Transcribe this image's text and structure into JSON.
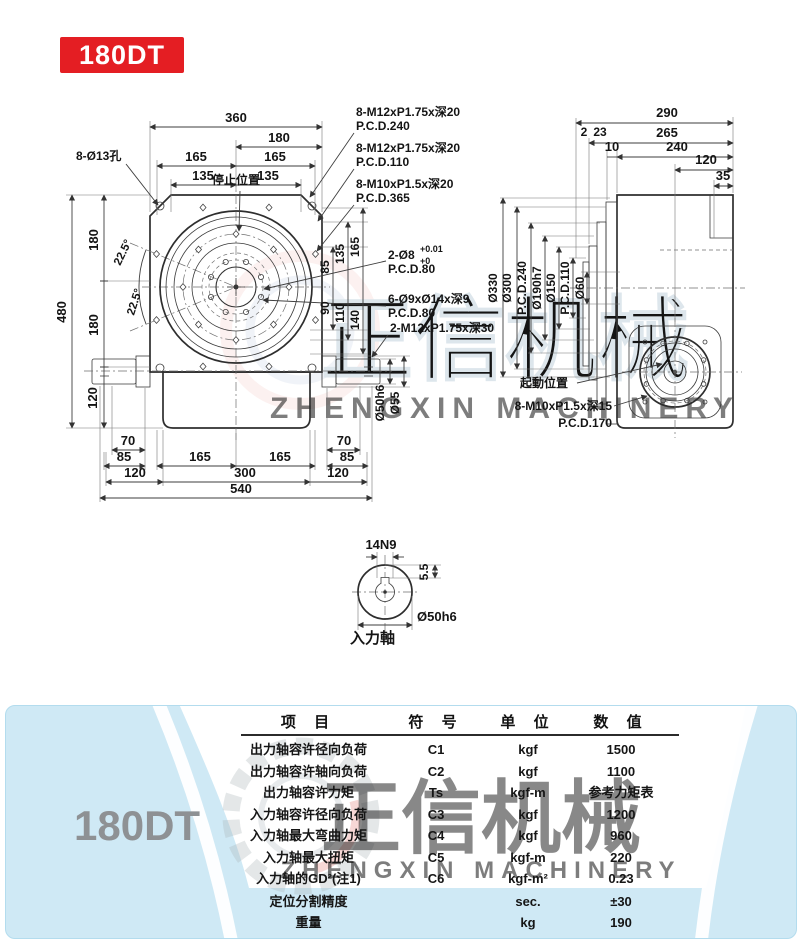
{
  "badge": {
    "label": "180DT"
  },
  "watermark": {
    "cn": "正信机械",
    "en": "ZHENGXIN MACHINERY"
  },
  "front": {
    "dim_360": "360",
    "dim_180": "180",
    "dim_165l": "165",
    "dim_165r": "165",
    "dim_135l": "135",
    "dim_135r": "135",
    "holes_label": "8-Ø13孔",
    "stop_label": "停止位置",
    "ann1_line1": "8-M12xP1.75x深20",
    "ann1_line2": "P.C.D.240",
    "ann2_line1": "8-M12xP1.75x深20",
    "ann2_line2": "P.C.D.110",
    "ann3_line1": "8-M10xP1.5x深20",
    "ann3_line2": "P.C.D.365",
    "ann4_main": "2-Ø8",
    "ann4_sup": "+0.01",
    "ann4_sub": "+0",
    "ann4_line2": "P.C.D.80",
    "ann5_line1": "6-Ø9xØ14x深9",
    "ann5_line2": "P.C.D.80",
    "ann6": "2-M12xP1.75x深30",
    "dim_480": "480",
    "dim_180a": "180",
    "dim_180b": "180",
    "dim_120l": "120",
    "angle1": "22.5°",
    "angle2": "22.5°",
    "dim_165v": "165",
    "dim_135v": "135",
    "dim_85v": "85",
    "dim_90v": "90",
    "dim_110v": "110",
    "dim_140v": "140",
    "dim_70a": "70",
    "dim_85a": "85",
    "dim_120a": "120",
    "dim_165b": "165",
    "dim_300": "300",
    "dim_165c": "165",
    "dim_120b": "120",
    "dim_85b": "85",
    "dim_70b": "70",
    "dim_540": "540",
    "shaft_d1": "Ø50h6",
    "shaft_d2": "Ø55"
  },
  "side": {
    "dim_290": "290",
    "dim_265": "265",
    "dim_2": "2",
    "dim_23": "23",
    "dim_10": "10",
    "dim_240": "240",
    "dim_120": "120",
    "dim_35": "35",
    "d_330": "Ø330",
    "d_300": "Ø300",
    "pcd_240": "P.C.D.240",
    "d_190": "Ø190h7",
    "d_150": "Ø150",
    "pcd_110": "P.C.D.110",
    "d_60": "Ø60",
    "start_label": "起動位置",
    "ann_line1": "8-M10xP1.5x深15",
    "ann_line2": "P.C.D.170"
  },
  "detail": {
    "key": "14N9",
    "depth": "5.5",
    "dia": "Ø50h6",
    "label": "入力軸"
  },
  "table": {
    "model": "180DT",
    "headers": [
      "项 目",
      "符 号",
      "单 位",
      "数 值"
    ],
    "rows": [
      {
        "item": "出力轴容许径向负荷",
        "sym": "C1",
        "unit": "kgf",
        "val": "1500"
      },
      {
        "item": "出力轴容许轴向负荷",
        "sym": "C2",
        "unit": "kgf",
        "val": "1100"
      },
      {
        "item": "出力轴容许力矩",
        "sym": "Ts",
        "unit": "kgf-m",
        "val": "参考力矩表"
      },
      {
        "item": "入力轴容许径向负荷",
        "sym": "C3",
        "unit": "kgf",
        "val": "1200"
      },
      {
        "item": "入力轴最大弯曲力矩",
        "sym": "C4",
        "unit": "kgf",
        "val": "960"
      },
      {
        "item": "入力轴最大扭矩",
        "sym": "C5",
        "unit": "kgf-m",
        "val": "220"
      },
      {
        "item": "入力轴的GD²(注1)",
        "sym": "C6",
        "unit": "kgf-m²",
        "val": "0.23"
      },
      {
        "item": "定位分割精度",
        "sym": "",
        "unit": "sec.",
        "val": "±30"
      },
      {
        "item": "重量",
        "sym": "",
        "unit": "kg",
        "val": "190"
      }
    ]
  },
  "colors": {
    "accent_red": "#e41e23",
    "body_fill": "#d9edf6",
    "panel_bg": "#cfe9f5",
    "line": "#2e2e2e"
  }
}
